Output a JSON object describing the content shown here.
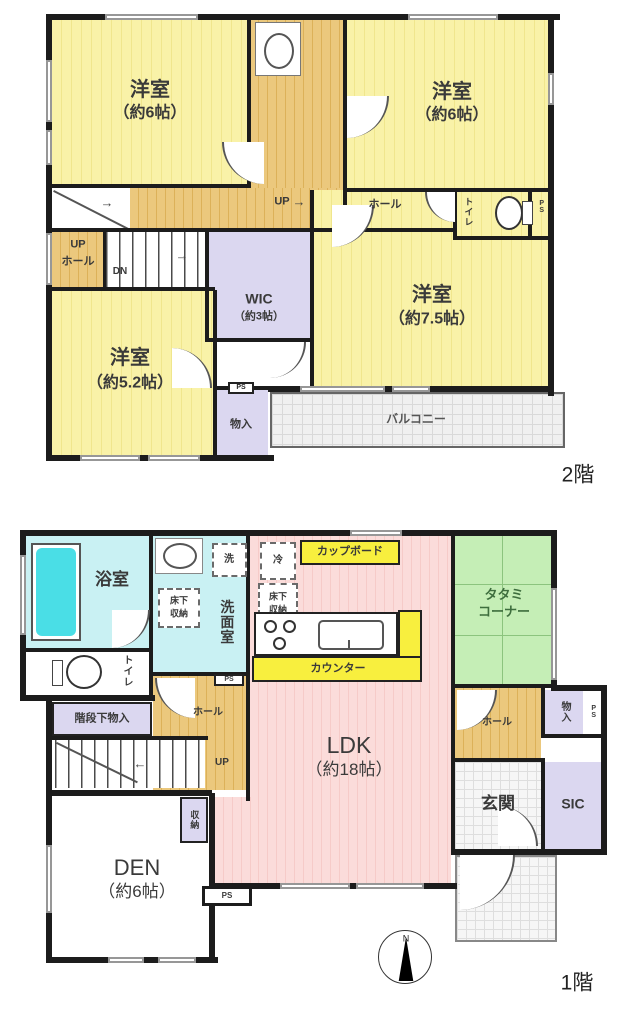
{
  "title": "間取り図",
  "colors": {
    "wall": "#1c1c1c",
    "room_yellow": "#f6ef9e",
    "hall_wood": "#e5c172",
    "water_cyan": "#c9f1f3",
    "bathtub_cyan": "#4adee6",
    "closet_purple": "#dbd7f0",
    "ldk_pink": "#fad6d3",
    "tatami_green": "#c5eeb6",
    "highlight_yellow": "#f8ef3e"
  },
  "icons": {
    "arrow_right": "→",
    "arrow_left": "←"
  },
  "floor2": {
    "floor_label": "2階",
    "labels": {
      "room_nw_1": "洋室",
      "room_nw_2": "（約6帖）",
      "room_ne_1": "洋室",
      "room_ne_2": "（約6帖）",
      "room_75_1": "洋室",
      "room_75_2": "（約7.5帖）",
      "room_52_1": "洋室",
      "room_52_2": "（約5.2帖）",
      "wic_1": "WIC",
      "wic_2": "（約3帖）",
      "hall": "ホール",
      "up": "UP",
      "dn": "DN",
      "uphall_up": "UP",
      "uphall_hall": "ホール",
      "toilet": "トイレ",
      "ps_toilet": "PS",
      "ps_closet": "PS",
      "closet": "物入",
      "balcony": "バルコニー"
    }
  },
  "floor1": {
    "floor_label": "1階",
    "labels": {
      "bath": "浴室",
      "washroom": "洗面室",
      "washer": "洗",
      "fridge": "冷",
      "underfloor_wash_1": "床下",
      "underfloor_wash_2": "収納",
      "underfloor_kitchen_1": "床下",
      "underfloor_kitchen_2": "収納",
      "cupboard": "カップボード",
      "counter": "カウンター",
      "tatami_1": "タタミ",
      "tatami_2": "コーナー",
      "toilet": "トイレ",
      "understairs": "階段下物入",
      "hall_left": "ホール",
      "hall_right": "ホール",
      "up": "UP",
      "ldk_1": "LDK",
      "ldk_2": "（約18帖）",
      "den_1": "DEN",
      "den_2": "（約6帖）",
      "shuno": "収納",
      "closet": "物入",
      "ps_washroom": "PS",
      "ps_closet": "PS",
      "ps_den": "PS",
      "sic": "SIC",
      "entrance": "玄関",
      "compass_n": "N"
    }
  }
}
